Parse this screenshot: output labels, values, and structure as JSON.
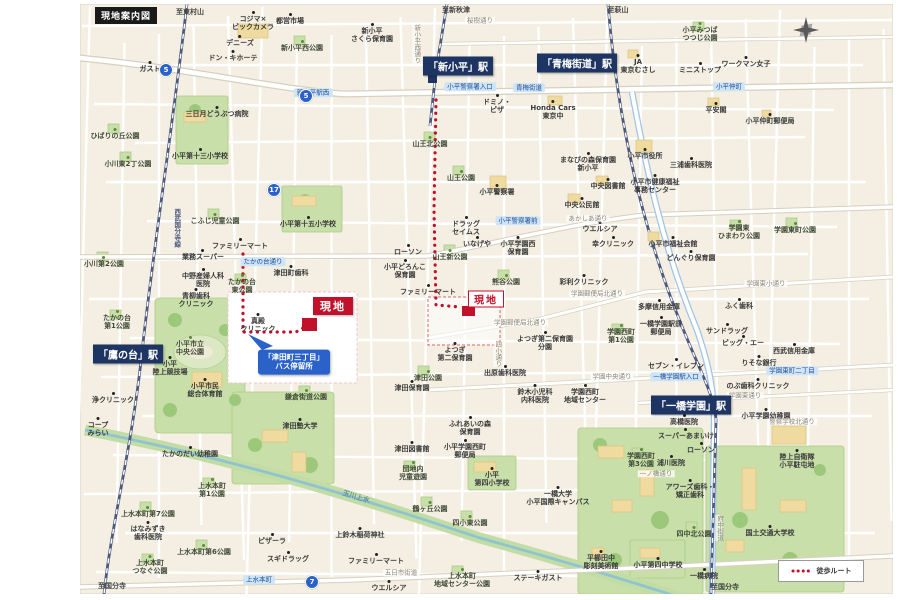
{
  "title": "現地案内図",
  "legend": {
    "walk_route": "徒歩ルート"
  },
  "bus_callout": {
    "line1": "「津田町三丁目」",
    "line2": "バス停留所"
  },
  "site_label_1": "現地",
  "site_label_2": "現地",
  "colors": {
    "accent_red": "#c2112a",
    "station_navy": "#1e3563",
    "callout_blue": "#2a62c9",
    "canal_teal": "#8fc3cf",
    "park_green": "#c9dfaa"
  },
  "stations": [
    {
      "name": "「新小平」駅",
      "x": 458,
      "y": 66
    },
    {
      "name": "「青梅街道」駅",
      "x": 577,
      "y": 63
    },
    {
      "name": "「鷹の台」駅",
      "x": 128,
      "y": 354
    },
    {
      "name": "「一橋学園」駅",
      "x": 691,
      "y": 405
    }
  ],
  "route_badges": [
    {
      "n": "5",
      "x": 166,
      "y": 70
    },
    {
      "n": "5",
      "x": 306,
      "y": 96
    },
    {
      "n": "17",
      "x": 274,
      "y": 190
    },
    {
      "n": "7",
      "x": 312,
      "y": 582
    }
  ],
  "labels": [
    {
      "t": "poi",
      "x": 150,
      "y": 67,
      "s": "ガスト"
    },
    {
      "t": "poi",
      "x": 253,
      "y": 21,
      "s": "コジマ×\nビックカメラ"
    },
    {
      "t": "poi",
      "x": 290,
      "y": 19,
      "s": "都営市場"
    },
    {
      "t": "park",
      "x": 302,
      "y": 46,
      "s": "新小平西公園"
    },
    {
      "t": "poi",
      "x": 240,
      "y": 41,
      "s": "デニーズ"
    },
    {
      "t": "poi",
      "x": 233,
      "y": 56,
      "s": "ドン・キホーテ"
    },
    {
      "t": "poi",
      "x": 372,
      "y": 33,
      "s": "新小平\nさくら保育園"
    },
    {
      "t": "dir",
      "x": 456,
      "y": 10,
      "s": "至新秋津"
    },
    {
      "t": "dir",
      "x": 190,
      "y": 12,
      "s": "至東村山"
    },
    {
      "t": "dir",
      "x": 618,
      "y": 10,
      "s": "至萩山"
    },
    {
      "t": "road",
      "x": 480,
      "y": 21,
      "s": "桜樹通り"
    },
    {
      "t": "poi",
      "x": 217,
      "y": 112,
      "s": "三日月どうぶつ病院"
    },
    {
      "t": "park",
      "x": 115,
      "y": 134,
      "s": "ひばりの丘公園"
    },
    {
      "t": "park",
      "x": 128,
      "y": 162,
      "s": "小川東2丁公園"
    },
    {
      "t": "school",
      "x": 200,
      "y": 154,
      "s": "小平第十三小学校"
    },
    {
      "t": "park",
      "x": 215,
      "y": 219,
      "s": "こふじ児童公園"
    },
    {
      "t": "school",
      "x": 308,
      "y": 222,
      "s": "小平第十五小学校"
    },
    {
      "t": "poi",
      "x": 240,
      "y": 244,
      "s": "ファミリーマート"
    },
    {
      "t": "poi",
      "x": 203,
      "y": 255,
      "s": "業務スーパー"
    },
    {
      "t": "poi",
      "x": 203,
      "y": 278,
      "s": "中野産婦人科\n医院"
    },
    {
      "t": "poi",
      "x": 196,
      "y": 298,
      "s": "青柳歯科\nクリニック"
    },
    {
      "t": "park",
      "x": 242,
      "y": 284,
      "s": "たかの台\n東公園"
    },
    {
      "t": "poi",
      "x": 291,
      "y": 271,
      "s": "津田町歯科"
    },
    {
      "t": "park",
      "x": 104,
      "y": 262,
      "s": "小川第2公園"
    },
    {
      "t": "vrail",
      "x": 176,
      "y": 228,
      "s": "西武国分寺線"
    },
    {
      "t": "park",
      "x": 190,
      "y": 346,
      "s": "小平市立\n中央公園"
    },
    {
      "t": "poi",
      "x": 170,
      "y": 366,
      "s": "小平\n陸上競技場"
    },
    {
      "t": "park",
      "x": 117,
      "y": 320,
      "s": "たかの台\n第1公園"
    },
    {
      "t": "poi",
      "x": 113,
      "y": 398,
      "s": "浄クリニック"
    },
    {
      "t": "poi",
      "x": 98,
      "y": 427,
      "s": "コープ\nみらい"
    },
    {
      "t": "poi",
      "x": 190,
      "y": 452,
      "s": "たかのだい幼稚園"
    },
    {
      "t": "poi",
      "x": 205,
      "y": 388,
      "s": "小平市民\n総合体育館"
    },
    {
      "t": "park",
      "x": 212,
      "y": 488,
      "s": "上水本町\n第1公園"
    },
    {
      "t": "park",
      "x": 148,
      "y": 512,
      "s": "上水本町第7公園"
    },
    {
      "t": "poi",
      "x": 148,
      "y": 531,
      "s": "はなみずき\n歯科医院"
    },
    {
      "t": "park",
      "x": 204,
      "y": 550,
      "s": "上水本町第6公園"
    },
    {
      "t": "park",
      "x": 150,
      "y": 565,
      "s": "上水本町\nつなぐ公園"
    },
    {
      "t": "poi",
      "x": 272,
      "y": 539,
      "s": "ピザーラ"
    },
    {
      "t": "poi",
      "x": 288,
      "y": 557,
      "s": "スギドラッグ"
    },
    {
      "t": "dir",
      "x": 112,
      "y": 586,
      "s": "至国分寺"
    },
    {
      "t": "poi",
      "x": 258,
      "y": 323,
      "s": "真殿\nクリニック"
    },
    {
      "t": "school",
      "x": 300,
      "y": 424,
      "s": "津田塾大学"
    },
    {
      "t": "park",
      "x": 306,
      "y": 395,
      "s": "鎌倉街道公園"
    },
    {
      "t": "poi",
      "x": 412,
      "y": 447,
      "s": "津田図書館"
    },
    {
      "t": "park",
      "x": 413,
      "y": 471,
      "s": "団地内\n児童遊園"
    },
    {
      "t": "poi",
      "x": 465,
      "y": 449,
      "s": "小平学園西町\n郵便局"
    },
    {
      "t": "school",
      "x": 492,
      "y": 477,
      "s": "小平\n第四小学校"
    },
    {
      "t": "poi",
      "x": 470,
      "y": 426,
      "s": "ふれあいの森\n保育園"
    },
    {
      "t": "park",
      "x": 430,
      "y": 507,
      "s": "鶴ヶ丘公園"
    },
    {
      "t": "park",
      "x": 470,
      "y": 521,
      "s": "四小東公園"
    },
    {
      "t": "school",
      "x": 558,
      "y": 496,
      "s": "一橋大学\n小平国際キャンパス"
    },
    {
      "t": "poi",
      "x": 360,
      "y": 533,
      "s": "上鈴木稲荷神社"
    },
    {
      "t": "poi",
      "x": 376,
      "y": 559,
      "s": "ファミリーマート"
    },
    {
      "t": "poi",
      "x": 389,
      "y": 586,
      "s": "ウエルシア"
    },
    {
      "t": "road",
      "x": 401,
      "y": 573,
      "s": "五日市街道"
    },
    {
      "t": "park",
      "x": 462,
      "y": 578,
      "s": "上水本町\n地域センター公園"
    },
    {
      "t": "poi",
      "x": 538,
      "y": 576,
      "s": "ステーキガスト"
    },
    {
      "t": "poi",
      "x": 601,
      "y": 560,
      "s": "平櫛田中\n彫刻美術館"
    },
    {
      "t": "canal",
      "x": 356,
      "y": 497,
      "s": "玉川上水"
    },
    {
      "t": "park",
      "x": 428,
      "y": 376,
      "s": "津田公園"
    },
    {
      "t": "poi",
      "x": 412,
      "y": 386,
      "s": "津田保育園"
    },
    {
      "t": "poi",
      "x": 455,
      "y": 352,
      "s": "よつぎ\n第二保育園"
    },
    {
      "t": "poi",
      "x": 545,
      "y": 341,
      "s": "よつぎ第二保育園\n分園"
    },
    {
      "t": "vroad",
      "x": 497,
      "y": 354,
      "s": "四小通り"
    },
    {
      "t": "park",
      "x": 506,
      "y": 280,
      "s": "熊谷公園"
    },
    {
      "t": "poi",
      "x": 584,
      "y": 280,
      "s": "彩利クリニック"
    },
    {
      "t": "road",
      "x": 597,
      "y": 294,
      "s": "学園郵便局北通り"
    },
    {
      "t": "road",
      "x": 520,
      "y": 323,
      "s": "学園郵便局北通り"
    },
    {
      "t": "park",
      "x": 621,
      "y": 334,
      "s": "学園西町\n第1公園"
    },
    {
      "t": "poi",
      "x": 676,
      "y": 364,
      "s": "セブン・イレブン"
    },
    {
      "t": "road",
      "x": 612,
      "y": 377,
      "s": "学園中央通り"
    },
    {
      "t": "poi",
      "x": 585,
      "y": 394,
      "s": "学園西町\n地域センター"
    },
    {
      "t": "poi",
      "x": 535,
      "y": 394,
      "s": "鈴木小児科\n内科医院"
    },
    {
      "t": "poi",
      "x": 505,
      "y": 371,
      "s": "出原歯科医院"
    },
    {
      "t": "poi",
      "x": 497,
      "y": 190,
      "s": "小平警察署"
    },
    {
      "t": "park",
      "x": 461,
      "y": 176,
      "s": "山王公園"
    },
    {
      "t": "park",
      "x": 430,
      "y": 142,
      "s": "山王北公園"
    },
    {
      "t": "poi",
      "x": 588,
      "y": 162,
      "s": "まなびの森保育園\n新小平"
    },
    {
      "t": "poi",
      "x": 608,
      "y": 184,
      "s": "中央図書館"
    },
    {
      "t": "poi",
      "x": 582,
      "y": 203,
      "s": "中央公民館"
    },
    {
      "t": "poi",
      "x": 466,
      "y": 226,
      "s": "ドラッグ\nセイムス"
    },
    {
      "t": "poi",
      "x": 477,
      "y": 242,
      "s": "いなげや"
    },
    {
      "t": "poi",
      "x": 408,
      "y": 250,
      "s": "ローソン"
    },
    {
      "t": "poi",
      "x": 405,
      "y": 269,
      "s": "小平どろんこ\n保育園"
    },
    {
      "t": "park",
      "x": 450,
      "y": 255,
      "s": "山王新公園"
    },
    {
      "t": "poi",
      "x": 428,
      "y": 290,
      "s": "ファミリーマート"
    },
    {
      "t": "poi",
      "x": 518,
      "y": 246,
      "s": "小平学園西\n保育園"
    },
    {
      "t": "poi",
      "x": 600,
      "y": 227,
      "s": "ウエルシア"
    },
    {
      "t": "poi",
      "x": 613,
      "y": 242,
      "s": "幸クリニック"
    },
    {
      "t": "road",
      "x": 588,
      "y": 219,
      "s": "あかしあ通り"
    },
    {
      "t": "poi",
      "x": 497,
      "y": 104,
      "s": "ドミノ・\nピザ"
    },
    {
      "t": "poi",
      "x": 553,
      "y": 110,
      "s": "Honda Cars\n東京中"
    },
    {
      "t": "poi",
      "x": 638,
      "y": 64,
      "s": "JA\n東京むさし"
    },
    {
      "t": "poi",
      "x": 700,
      "y": 68,
      "s": "ミニストップ"
    },
    {
      "t": "poi",
      "x": 746,
      "y": 62,
      "s": "ワークマン女子"
    },
    {
      "t": "park",
      "x": 700,
      "y": 32,
      "s": "小平みつば\nつつじ公園"
    },
    {
      "t": "poi",
      "x": 645,
      "y": 154,
      "s": "小平市役所"
    },
    {
      "t": "poi",
      "x": 691,
      "y": 163,
      "s": "三浦歯科医院"
    },
    {
      "t": "poi",
      "x": 655,
      "y": 184,
      "s": "小平市健康福祉\n事務センター"
    },
    {
      "t": "poi",
      "x": 770,
      "y": 119,
      "s": "小平仲町郵便局"
    },
    {
      "t": "poi",
      "x": 716,
      "y": 108,
      "s": "平安閣"
    },
    {
      "t": "park",
      "x": 739,
      "y": 230,
      "s": "学園東\nひまわり公園"
    },
    {
      "t": "park",
      "x": 795,
      "y": 228,
      "s": "学園東町公園"
    },
    {
      "t": "poi",
      "x": 691,
      "y": 256,
      "s": "どんぐり保育園"
    },
    {
      "t": "poi",
      "x": 673,
      "y": 242,
      "s": "小平市福祉会館"
    },
    {
      "t": "poi",
      "x": 659,
      "y": 305,
      "s": "多摩信用金庫"
    },
    {
      "t": "poi",
      "x": 661,
      "y": 326,
      "s": "一橋学園駅前\n郵便局"
    },
    {
      "t": "poi",
      "x": 739,
      "y": 304,
      "s": "ふく歯科"
    },
    {
      "t": "poi",
      "x": 727,
      "y": 329,
      "s": "サンドラッグ"
    },
    {
      "t": "poi",
      "x": 743,
      "y": 341,
      "s": "ビッグ・エー"
    },
    {
      "t": "poi",
      "x": 759,
      "y": 361,
      "s": "りそな銀行"
    },
    {
      "t": "poi",
      "x": 794,
      "y": 349,
      "s": "西武信用金庫"
    },
    {
      "t": "poi",
      "x": 758,
      "y": 384,
      "s": "のぶ歯科クリニック"
    },
    {
      "t": "road",
      "x": 745,
      "y": 396,
      "s": "学園東通り"
    },
    {
      "t": "poi",
      "x": 766,
      "y": 414,
      "s": "小平学園幼稚園"
    },
    {
      "t": "road",
      "x": 792,
      "y": 422,
      "s": "警察学校北通り"
    },
    {
      "t": "road",
      "x": 766,
      "y": 284,
      "s": "学園東小通り"
    },
    {
      "t": "poi",
      "x": 684,
      "y": 420,
      "s": "高橋医院"
    },
    {
      "t": "poi",
      "x": 686,
      "y": 434,
      "s": "スーパーあまいけ"
    },
    {
      "t": "poi",
      "x": 701,
      "y": 448,
      "s": "ローソン"
    },
    {
      "t": "poi",
      "x": 671,
      "y": 461,
      "s": "浦川医院"
    },
    {
      "t": "park",
      "x": 641,
      "y": 458,
      "s": "学園西町\n第3公園"
    },
    {
      "t": "road",
      "x": 656,
      "y": 474,
      "s": "一ノ橋通り"
    },
    {
      "t": "poi",
      "x": 690,
      "y": 489,
      "s": "アワーズ歯科・\n矯正歯科"
    },
    {
      "t": "poi",
      "x": 797,
      "y": 459,
      "s": "陸上自衛隊\n小平駐屯地"
    },
    {
      "t": "park",
      "x": 694,
      "y": 532,
      "s": "四中北公園"
    },
    {
      "t": "school",
      "x": 770,
      "y": 531,
      "s": "国土交通大学校"
    },
    {
      "t": "school",
      "x": 658,
      "y": 563,
      "s": "小平第四中学校"
    },
    {
      "t": "poi",
      "x": 704,
      "y": 574,
      "s": "一橋病院"
    },
    {
      "t": "dir",
      "x": 725,
      "y": 587,
      "s": "至国分寺"
    },
    {
      "t": "vroad",
      "x": 719,
      "y": 528,
      "s": "府中街道"
    },
    {
      "t": "vroad",
      "x": 416,
      "y": 44,
      "s": "新小平西通り"
    },
    {
      "t": "roadblue",
      "x": 529,
      "y": 88,
      "s": "青梅街道"
    },
    {
      "t": "roadblue",
      "x": 470,
      "y": 87,
      "s": "小平警察署入口"
    },
    {
      "t": "roadblue",
      "x": 313,
      "y": 93,
      "s": "新小平駅西"
    },
    {
      "t": "roadblue",
      "x": 729,
      "y": 87,
      "s": "小平仲町"
    },
    {
      "t": "roadblue",
      "x": 518,
      "y": 221,
      "s": "小平警察署前"
    },
    {
      "t": "roadblue",
      "x": 263,
      "y": 262,
      "s": "たかの台通り"
    },
    {
      "t": "roadblue",
      "x": 676,
      "y": 377,
      "s": "一橋学園駅入口"
    },
    {
      "t": "roadblue",
      "x": 792,
      "y": 371,
      "s": "学園東町二丁目"
    },
    {
      "t": "roadblue",
      "x": 259,
      "y": 580,
      "s": "上水本町"
    }
  ]
}
